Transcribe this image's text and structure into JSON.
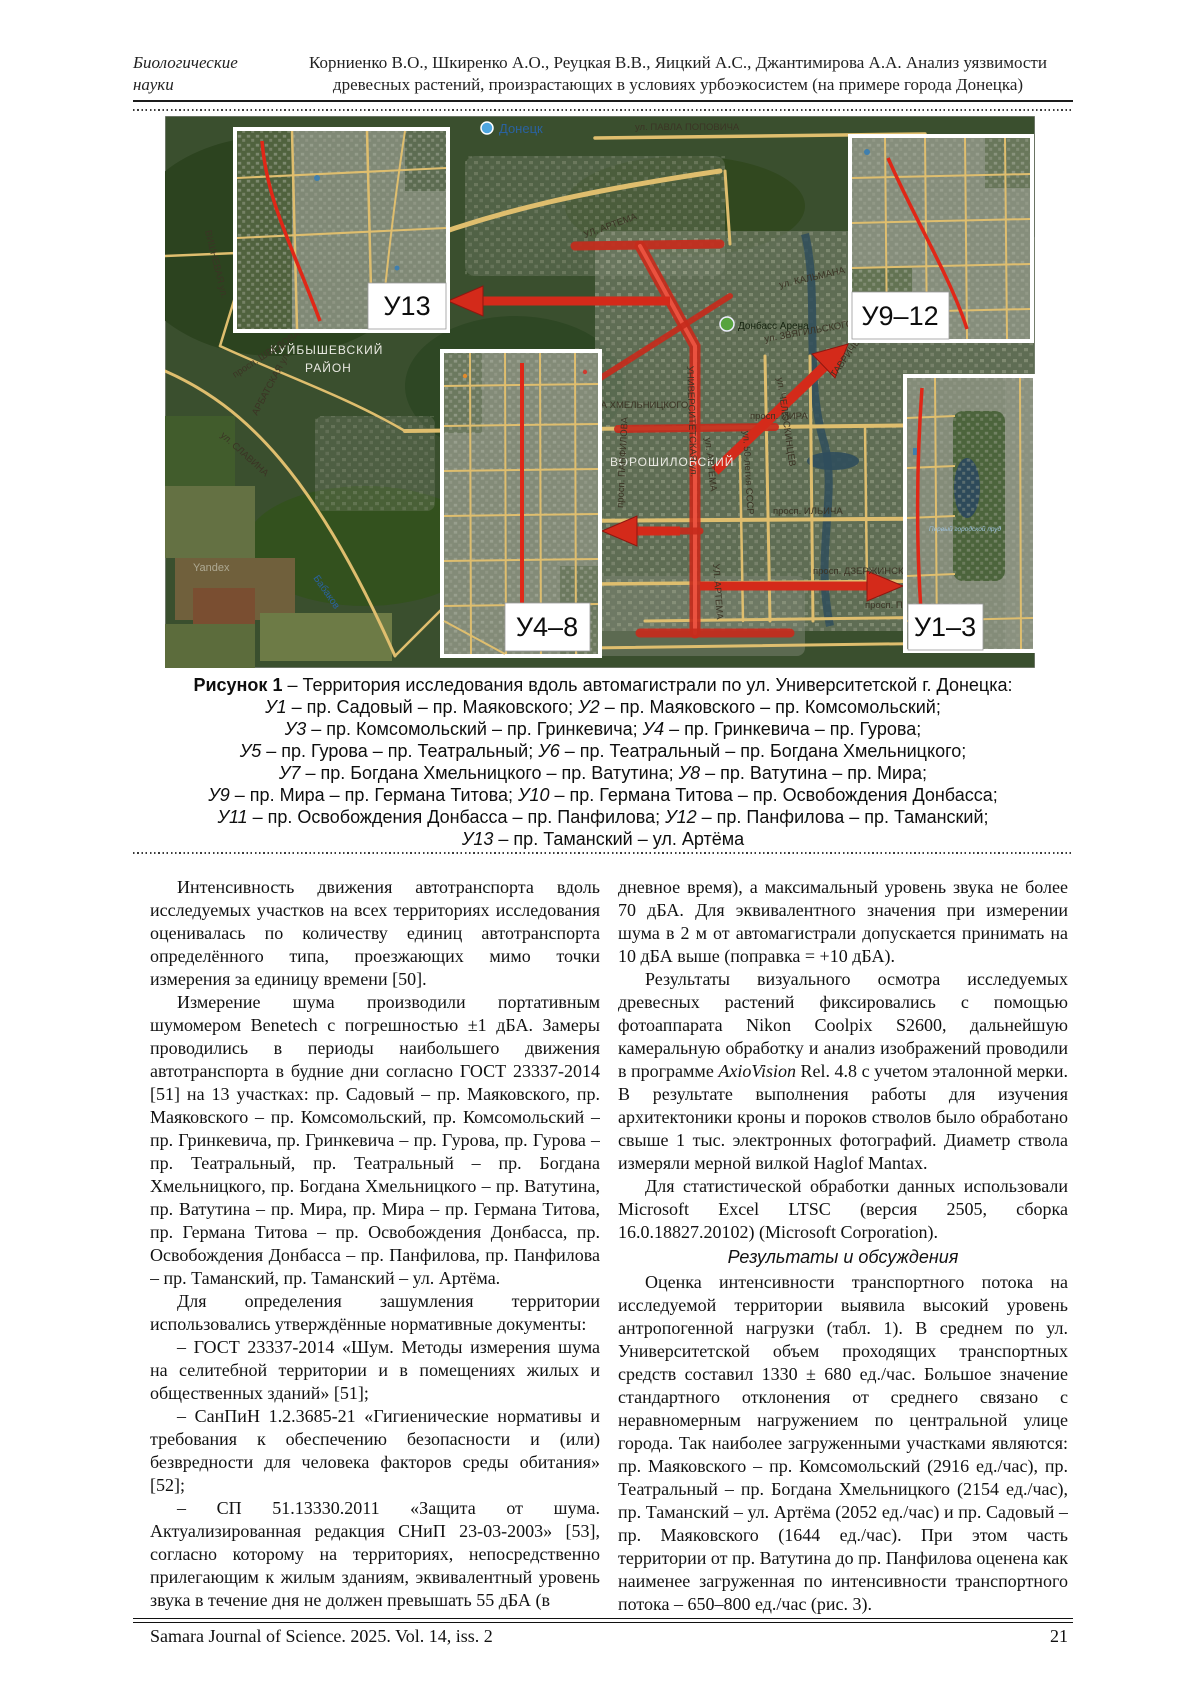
{
  "header": {
    "section_line1": "Биологические",
    "section_line2": "науки",
    "title_line1": "Корниенко В.О., Шкиренко А.О., Реуцкая В.В., Яицкий А.С., Джантимирова А.А. Анализ уязвимости",
    "title_line2": "древесных растений, произрастающих в условиях урбоэкосистем (на примере города Донецка)"
  },
  "figure": {
    "insets": [
      {
        "label": "У13"
      },
      {
        "label": "У9–12"
      },
      {
        "label": "У4–8"
      },
      {
        "label": "У1–3"
      }
    ],
    "map_labels": [
      {
        "text": "Донецк"
      },
      {
        "text": "ул. ПАВЛА ПОПОВИЧА"
      },
      {
        "text": "УЛ. АРТЕМА"
      },
      {
        "text": "ул. КАЛЬМАНА"
      },
      {
        "text": "ул. ЗВЯГИЛЬСКОГО"
      },
      {
        "text": "ул. ЧЕЛЮСКИНЦЕВ"
      },
      {
        "text": "КУЙБЫШЕВСКИЙ"
      },
      {
        "text": "РАЙОН"
      },
      {
        "text": "Донбасс Арена"
      },
      {
        "text": "просп. МИРА"
      },
      {
        "text": "просп. МИРА"
      },
      {
        "text": "ТАВРИЧЕСКАЯ ул."
      },
      {
        "text": "просп. ИЛЬИЧА"
      },
      {
        "text": "просп. ДЗЕРЖИНСКОГО"
      },
      {
        "text": "просп. ПАВШ"
      },
      {
        "text": "ВОРОШИЛОВСКИЙ"
      },
      {
        "text": "ул. АРТЕМА"
      },
      {
        "text": "УЛ. АРТЕМА"
      },
      {
        "text": "БОГДАНА ХМЕЛЬНИЦКОГО"
      },
      {
        "text": "УНИВЕРСИТЕТСКАЯ ул."
      },
      {
        "text": "ул. СОМОВА"
      },
      {
        "text": "ул. СЛАВИНА"
      },
      {
        "text": "просп. ШВЕДОВА"
      },
      {
        "text": "АРБАТСКАЯ ул."
      },
      {
        "text": "ВИШНЕВАЯ ул."
      },
      {
        "text": "Бабаков"
      },
      {
        "text": "просп. ПАНФИЛОВА"
      },
      {
        "text": "ул. 50-летия СССР"
      },
      {
        "text": "Первый городской пруд"
      },
      {
        "text": "Yandex"
      }
    ],
    "caption_lines": [
      "**Рисунок 1** – Территория исследования вдоль автомагистрали по ул. Университетской г. Донецка:",
      "*У1* – пр. Садовый – пр. Маяковского; *У2* – пр. Маяковского – пр. Комсомольский;",
      "*У3* – пр. Комсомольский – пр. Гринкевича; *У4* – пр. Гринкевича – пр. Гурова;",
      "*У5* – пр. Гурова – пр. Театральный; *У6* – пр. Театральный – пр. Богдана Хмельницкого;",
      "*У7* – пр. Богдана Хмельницкого – пр. Ватутина; *У8* – пр. Ватутина – пр. Мира;",
      "*У9* – пр. Мира – пр. Германа Титова; *У10* – пр. Германа Титова – пр. Освобождения Донбасса;",
      "*У11* – пр. Освобождения Донбасса – пр. Панфилова; *У12* – пр. Панфилова – пр. Таманский;",
      "*У13* – пр. Таманский – ул. Артёма"
    ],
    "colors": {
      "route_red": "#d42a1a",
      "road_yellow": "#dfbe6e",
      "map_green": "#3a4f2e",
      "water_blue": "#2f4d5c"
    }
  },
  "columns": {
    "left": [
      {
        "text": "Интенсивность движения автотранспорта вдоль исследуемых участков на всех территориях исследования оценивалась по количеству единиц автотранспорта определённого типа, проезжающих мимо точки измерения за единицу времени [50]."
      },
      {
        "text": "Измерение шума производили портативным шумомером Benetech с погрешностью ±1 дБА. Замеры проводились в периоды наибольшего движения автотранспорта в будние дни согласно ГОСТ 23337-2014 [51] на 13 участках: пр. Садовый – пр. Маяковского, пр. Маяковского – пр. Комсомольский, пр. Комсомольский – пр. Гринкевича, пр. Гринкевича – пр. Гурова, пр. Гурова – пр. Театральный, пр. Театральный – пр. Богдана Хмельницкого, пр. Богдана Хмельницкого – пр. Ватутина, пр. Ватутина – пр. Мира, пр. Мира – пр. Германа Титова, пр. Германа Титова – пр. Освобождения Донбасса, пр. Освобождения Донбасса – пр. Панфилова, пр. Панфилова – пр. Таманский, пр. Таманский – ул. Артёма."
      },
      {
        "text": "Для определения зашумления территории использовались утверждённые нормативные документы:"
      },
      {
        "text": "– ГОСТ 23337-2014 «Шум. Методы измерения шума на селитебной территории и в помещениях жилых и общественных зданий» [51];"
      },
      {
        "text": "– СанПиН 1.2.3685-21 «Гигиенические нормативы и требования к обеспечению безопасности и (или) безвредности для человека факторов среды обитания» [52];"
      },
      {
        "text": "– СП 51.13330.2011 «Защита от шума. Актуализированная редакция СНиП 23-03-2003» [53], согласно которому на территориях, непосредственно прилегающим к жилым зданиям, эквивалентный уровень звука в течение дня не должен превышать 55 дБА (в"
      }
    ],
    "right": [
      {
        "noindent": true,
        "text": "дневное время), а максимальный уровень звука не более 70 дБА. Для эквивалентного значения при измерении шума в 2 м от автомагистрали допускается принимать на 10 дБА выше (поправка = +10 дБА)."
      },
      {
        "text": "Результаты визуального осмотра исследуемых древесных растений фиксировались с помощью фотоаппарата Nikon Coolpix S2600, дальнейшую камеральную обработку и анализ изображений проводили в программе *AxioVision* Rel. 4.8 с учетом эталонной мерки. В результате выполнения работы для изучения архитектоники кроны и пороков стволов было обработано свыше 1 тыс. электронных фотографий. Диаметр ствола измеряли мерной вилкой Haglof Mantax."
      },
      {
        "text": "Для статистической обработки данных использовали Microsoft Excel LTSC (версия 2505, сборка 16.0.18827.20102) (Microsoft Corporation)."
      },
      {
        "heading": true,
        "text": "Результаты и обсуждения"
      },
      {
        "text": "Оценка интенсивности транспортного потока на исследуемой территории выявила высокий уровень антропогенной нагрузки (табл. 1). В среднем по ул. Университетской объем проходящих транспортных средств составил 1330 ± 680 ед./час. Большое значение стандартного отклонения от среднего связано с неравномерным нагружением по центральной улице города. Так наиболее загруженными участками являются: пр. Маяковского – пр. Комсомольский (2916 ед./час), пр. Театральный – пр. Богдана Хмельницкого (2154 ед./час), пр. Таманский – ул. Артёма (2052 ед./час) и пр. Садовый – пр. Маяковского (1644 ед./час). При этом часть территории от пр. Ватутина до пр. Панфилова оценена как наименее загруженная по интенсивности транспортного потока – 650–800 ед./час (рис. 3)."
      }
    ]
  },
  "footer": {
    "journal": "Samara Journal of Science. 2025. Vol. 14, iss. 2",
    "page": "21"
  }
}
